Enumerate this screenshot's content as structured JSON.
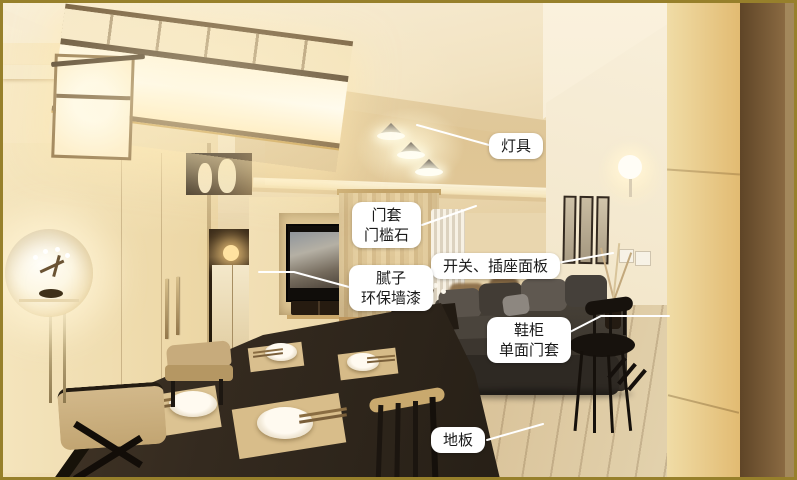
{
  "colors": {
    "frame_border": "#97802b",
    "label_background": "#ffffff",
    "label_text": "#1a1a1a",
    "leader_line": "#ffffff"
  },
  "annotations": [
    {
      "id": "lighting",
      "lines": [
        "灯具"
      ]
    },
    {
      "id": "door-casing",
      "lines": [
        "门套",
        "门槛石"
      ]
    },
    {
      "id": "switch-socket-panel",
      "lines": [
        "开关、插座面板"
      ]
    },
    {
      "id": "putty-eco-paint",
      "lines": [
        "腻子",
        "环保墙漆"
      ]
    },
    {
      "id": "shoe-cabinet",
      "lines": [
        "鞋柜",
        "单面门套"
      ]
    },
    {
      "id": "floor",
      "lines": [
        "地板"
      ]
    }
  ]
}
